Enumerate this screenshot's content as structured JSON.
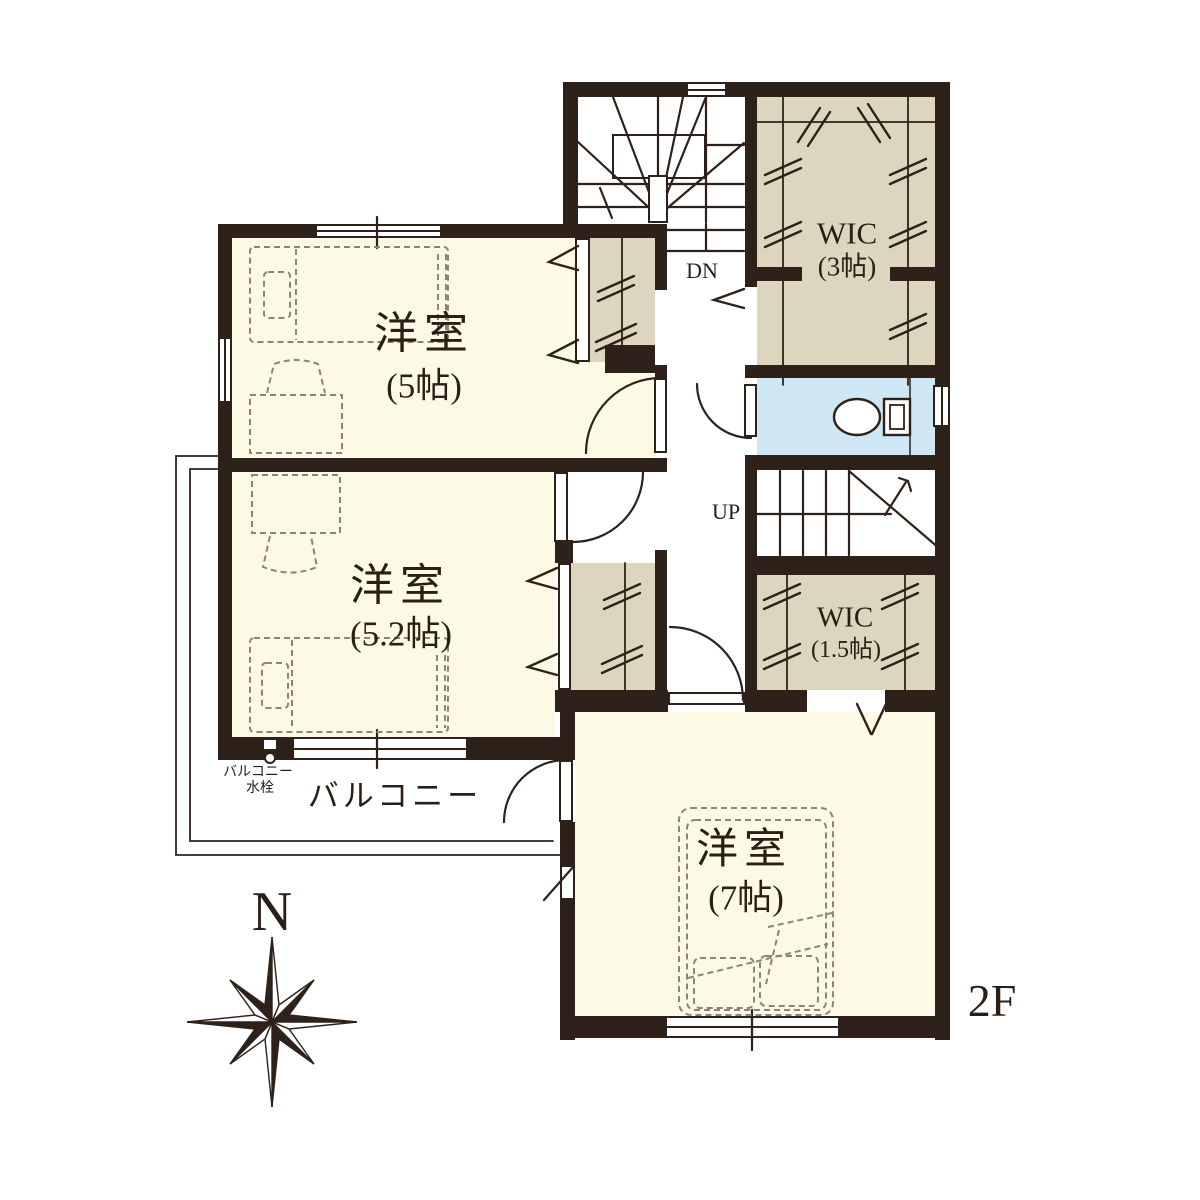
{
  "floor": {
    "label": "2F"
  },
  "compass": {
    "north": "N"
  },
  "rooms": {
    "bedroom_5": {
      "name": "洋室",
      "size": "(5帖)"
    },
    "bedroom_5_2": {
      "name": "洋室",
      "size": "(5.2帖)"
    },
    "bedroom_7": {
      "name": "洋室",
      "size": "(7帖)"
    },
    "wic_3": {
      "name": "WIC",
      "size": "(3帖)"
    },
    "wic_1_5": {
      "name": "WIC",
      "size": "(1.5帖)"
    },
    "balcony": {
      "name": "バルコニー"
    }
  },
  "stairs": {
    "down": "DN",
    "up": "UP"
  },
  "annotations": {
    "balcony_faucet": [
      "バルコニー",
      "水栓"
    ]
  },
  "colors": {
    "wall": "#2e211a",
    "room": "#fcfae5",
    "closet": "#ded5bf",
    "toilet": "#cfe6f5",
    "furn": "#8b8578",
    "paper": "#ffffff",
    "text": "#2b1e15"
  }
}
